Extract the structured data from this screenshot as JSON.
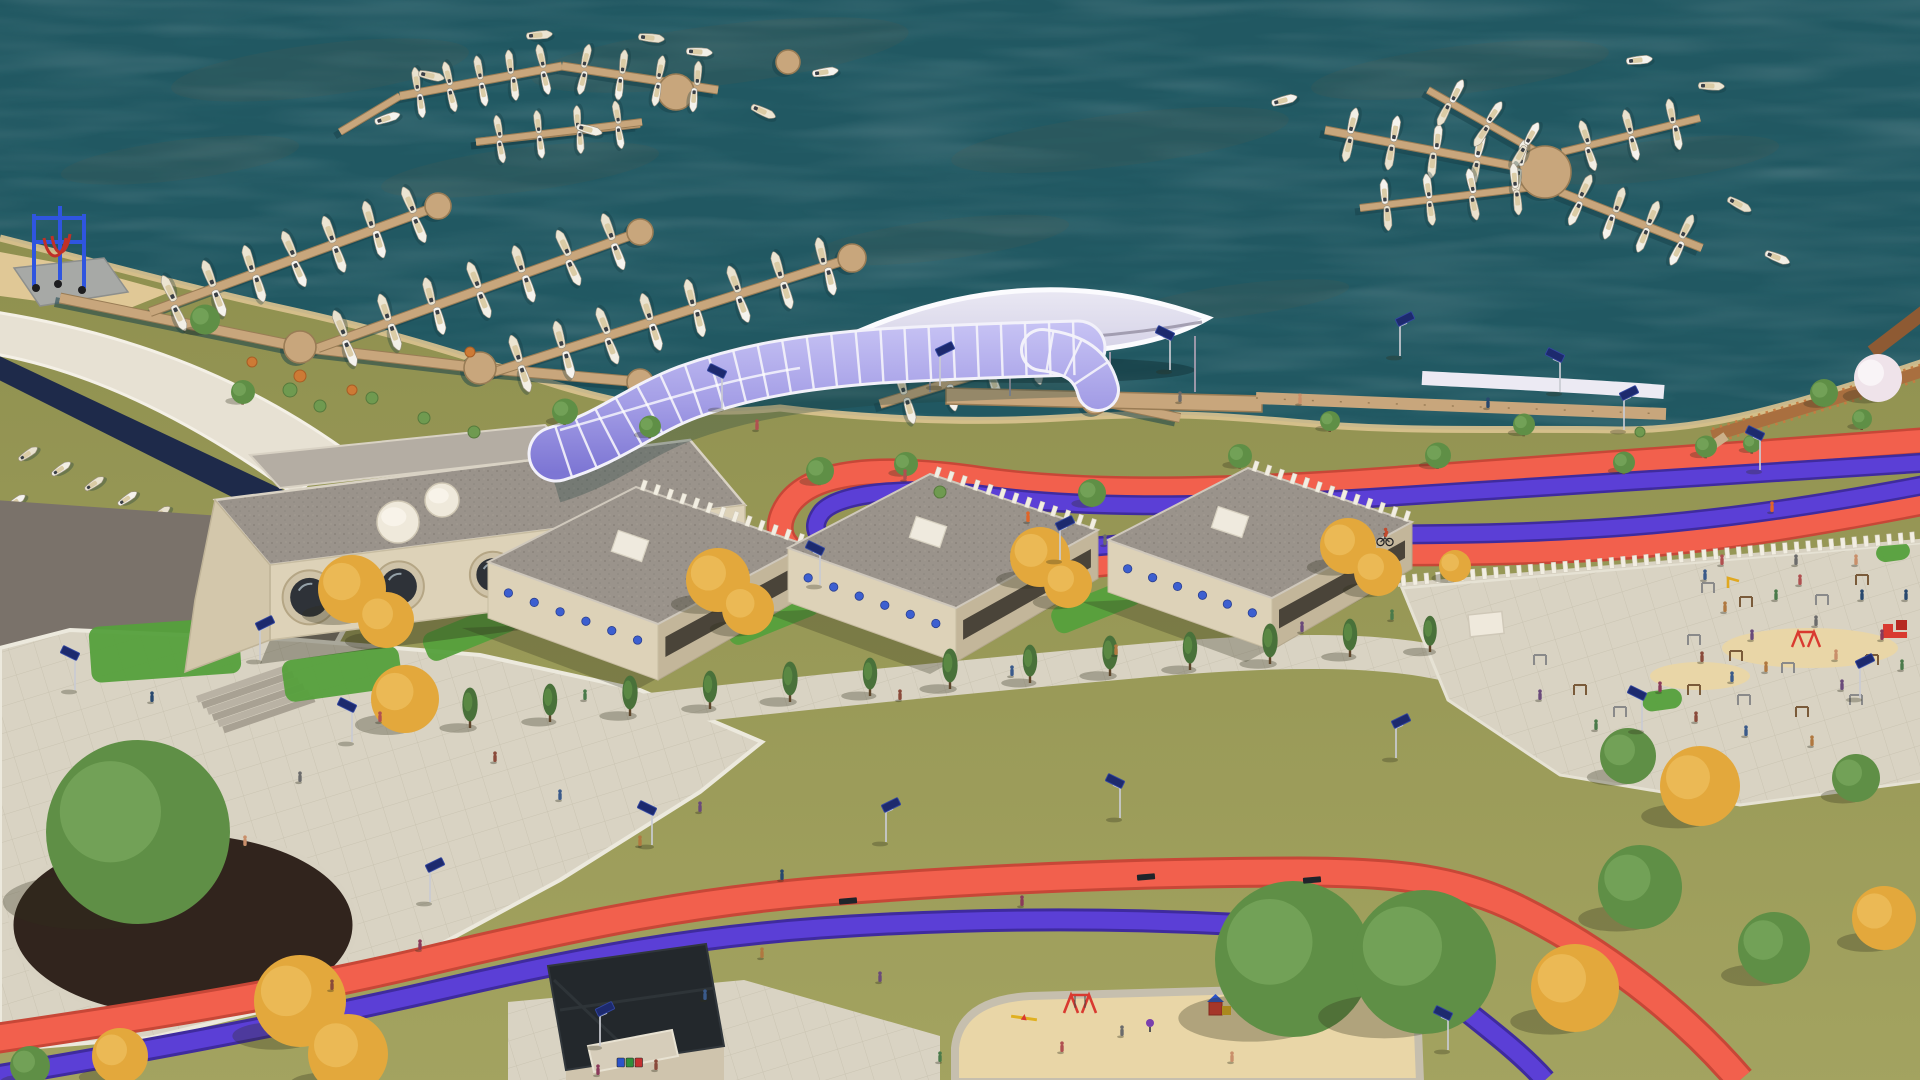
{
  "meta": {
    "title": "Aerial 3D architectural rendering of a marina waterfront development",
    "view": "isometric aerial render, no UI text visible",
    "width": 1920,
    "height": 1080
  },
  "palette": {
    "water": "#26606a",
    "waterDeep": "#1d4f58",
    "dockWood": "#c8a67c",
    "dockEdge": "#997c55",
    "grassA": "#a2a260",
    "grassB": "#8e8f4f",
    "lawnGreen": "#55a03c",
    "pavement": "#d9d3c3",
    "pavementLine": "#c2bba9",
    "sand": "#e9d6a7",
    "asphalt": "#7a726a",
    "mulch": "#31241d",
    "boatDeck": "#d9c9a2",
    "buildingWall": "#ddd2b8",
    "buildingWallShade": "#c3b69a",
    "roofGravel": "#9a938b",
    "roofDot": "#857f77",
    "canopyWhite": "#eceaf3",
    "tubeLight": "#c6c2f4",
    "tubeDark": "#7d76d4",
    "tubeRib": "#f5f4fb",
    "trackRed": "#f2604d",
    "trackRedDark": "#c74737",
    "bikePurple": "#5b3fd6",
    "bikePurpleDark": "#3f2b9e",
    "liftBlue": "#2f55e0",
    "treeGreen": "#5f8f46",
    "treeGreenDark": "#49713a",
    "treeAutumn": "#e3a83c",
    "treeAutumnDark": "#c9882a",
    "treeBloom": "#efe3ea",
    "boardwalk": "#a96f3f",
    "lampPanel": "#1d2a6e",
    "equipRed": "#d93a30",
    "shadow": "#2e2e1c"
  },
  "water": {
    "algae": [
      [
        320,
        70,
        150,
        26
      ],
      [
        720,
        55,
        190,
        30
      ],
      [
        1120,
        140,
        170,
        26
      ],
      [
        520,
        170,
        140,
        22
      ],
      [
        1460,
        70,
        150,
        24
      ],
      [
        940,
        240,
        130,
        20
      ],
      [
        180,
        160,
        120,
        20
      ],
      [
        1660,
        160,
        120,
        20
      ],
      [
        820,
        350,
        120,
        18
      ],
      [
        1240,
        300,
        110,
        16
      ]
    ]
  },
  "marina": {
    "walkways": [
      {
        "pts": [
          [
            60,
            298
          ],
          [
            300,
            347
          ],
          [
            480,
            368
          ],
          [
            640,
            382
          ]
        ],
        "w": 9
      },
      {
        "pts": [
          [
            340,
            132
          ],
          [
            400,
            96
          ]
        ],
        "w": 6
      },
      {
        "pts": [
          [
            476,
            142
          ],
          [
            640,
            124
          ]
        ],
        "w": 6
      },
      {
        "pts": [
          [
            1095,
            400
          ],
          [
            1180,
            418
          ]
        ],
        "w": 8
      }
    ],
    "piers": [
      {
        "x1": 150,
        "y1": 312,
        "x2": 438,
        "y2": 206,
        "w": 8,
        "n": 7,
        "len": 27
      },
      {
        "x1": 318,
        "y1": 348,
        "x2": 640,
        "y2": 232,
        "w": 8,
        "n": 7,
        "len": 27
      },
      {
        "x1": 494,
        "y1": 372,
        "x2": 852,
        "y2": 258,
        "w": 8,
        "n": 8,
        "len": 27
      },
      {
        "x1": 880,
        "y1": 404,
        "x2": 1100,
        "y2": 336,
        "w": 8,
        "n": 5,
        "len": 26
      },
      {
        "x1": 400,
        "y1": 96,
        "x2": 562,
        "y2": 66,
        "w": 7,
        "n": 5,
        "len": 23
      },
      {
        "x1": 562,
        "y1": 66,
        "x2": 718,
        "y2": 90,
        "w": 7,
        "n": 4,
        "len": 23
      },
      {
        "x1": 476,
        "y1": 142,
        "x2": 642,
        "y2": 122,
        "w": 6,
        "n": 4,
        "len": 22
      },
      {
        "x1": 1545,
        "y1": 172,
        "x2": 1325,
        "y2": 130,
        "w": 7,
        "n": 5,
        "len": 25
      },
      {
        "x1": 1548,
        "y1": 158,
        "x2": 1428,
        "y2": 90,
        "w": 6,
        "n": 3,
        "len": 24
      },
      {
        "x1": 1542,
        "y1": 186,
        "x2": 1360,
        "y2": 208,
        "w": 6,
        "n": 4,
        "len": 24
      },
      {
        "x1": 1560,
        "y1": 192,
        "x2": 1702,
        "y2": 248,
        "w": 7,
        "n": 4,
        "len": 25
      },
      {
        "x1": 1562,
        "y1": 152,
        "x2": 1700,
        "y2": 118,
        "w": 6,
        "n": 3,
        "len": 24
      }
    ],
    "platforms": [
      [
        300,
        347,
        16
      ],
      [
        480,
        368,
        16
      ],
      [
        640,
        382,
        13
      ],
      [
        438,
        206,
        13
      ],
      [
        640,
        232,
        13
      ],
      [
        852,
        258,
        14
      ],
      [
        1545,
        172,
        26
      ],
      [
        676,
        92,
        18
      ],
      [
        788,
        62,
        12
      ],
      [
        1095,
        400,
        14
      ]
    ],
    "freeBoats": [
      [
        388,
        118,
        -18
      ],
      [
        432,
        76,
        12
      ],
      [
        700,
        52,
        4
      ],
      [
        764,
        112,
        24
      ],
      [
        826,
        72,
        -8
      ],
      [
        652,
        38,
        6
      ],
      [
        590,
        130,
        15
      ],
      [
        540,
        35,
        -5
      ],
      [
        1285,
        100,
        -15
      ],
      [
        1740,
        205,
        28
      ],
      [
        1778,
        258,
        22
      ],
      [
        1712,
        86,
        2
      ],
      [
        1640,
        60,
        -6
      ]
    ],
    "rackRows": [
      {
        "x1": 12,
        "y1": 446,
        "x2": 244,
        "y2": 550,
        "n": 7
      },
      {
        "x1": 0,
        "y1": 494,
        "x2": 196,
        "y2": 580,
        "n": 6
      }
    ]
  },
  "ship": {
    "portholes": {
      "t": [
        0.08,
        0.27,
        0.47,
        0.67,
        0.86
      ],
      "r": [
        27,
        25,
        23,
        21,
        19
      ]
    },
    "wallTop": [
      272,
      602
    ],
    "wallEnd": [
      742,
      544
    ],
    "cylinders": [
      [
        398,
        522,
        21
      ],
      [
        442,
        500,
        17
      ]
    ]
  },
  "pavilions": [
    {
      "w": [
        488,
        562
      ],
      "n": [
        636,
        487
      ],
      "e": [
        806,
        545
      ],
      "s": [
        658,
        624
      ],
      "h": 56,
      "dots": 6,
      "teeth": 13,
      "box": [
        630,
        546
      ]
    },
    {
      "w": [
        788,
        548
      ],
      "n": [
        930,
        474
      ],
      "e": [
        1098,
        530
      ],
      "s": [
        956,
        608
      ],
      "h": 54,
      "dots": 6,
      "teeth": 13,
      "box": [
        928,
        532
      ]
    },
    {
      "w": [
        1108,
        540
      ],
      "n": [
        1248,
        468
      ],
      "e": [
        1412,
        522
      ],
      "s": [
        1272,
        598
      ],
      "h": 52,
      "dots": 6,
      "teeth": 13,
      "box": [
        1230,
        522
      ]
    }
  ],
  "plazaWall": {
    "x1": 1398,
    "y1": 585,
    "x2": 1930,
    "y2": 540,
    "teeth": 46
  },
  "lawns": [
    [
      165,
      650,
      150,
      56,
      -4
    ],
    [
      342,
      674,
      118,
      42,
      -8
    ],
    [
      470,
      632,
      96,
      30,
      -22
    ],
    [
      772,
      616,
      96,
      30,
      -22
    ],
    [
      1096,
      606,
      92,
      28,
      -22
    ],
    [
      1893,
      552,
      34,
      18,
      -8
    ],
    [
      1662,
      700,
      40,
      20,
      -8
    ]
  ],
  "trees": {
    "green": [
      [
        205,
        327,
        15
      ],
      [
        243,
        398,
        12
      ],
      [
        565,
        418,
        13
      ],
      [
        650,
        432,
        11
      ],
      [
        820,
        478,
        14
      ],
      [
        906,
        470,
        12
      ],
      [
        1092,
        500,
        14
      ],
      [
        1240,
        462,
        12
      ],
      [
        1330,
        426,
        10
      ],
      [
        1438,
        462,
        13
      ],
      [
        1524,
        430,
        11
      ],
      [
        1624,
        468,
        11
      ],
      [
        1706,
        452,
        11
      ],
      [
        1752,
        448,
        9
      ],
      [
        1824,
        400,
        14
      ],
      [
        1862,
        424,
        10
      ],
      [
        138,
        878,
        92
      ],
      [
        1293,
        998,
        78
      ],
      [
        1424,
        998,
        72
      ],
      [
        1640,
        908,
        42
      ],
      [
        1774,
        966,
        36
      ],
      [
        1628,
        770,
        28
      ],
      [
        1856,
        790,
        24
      ],
      [
        30,
        1076,
        20
      ]
    ],
    "autumn": [
      [
        352,
        606,
        34
      ],
      [
        386,
        634,
        28
      ],
      [
        718,
        596,
        32
      ],
      [
        748,
        622,
        26
      ],
      [
        1040,
        572,
        30
      ],
      [
        1068,
        596,
        24
      ],
      [
        1348,
        560,
        28
      ],
      [
        1378,
        584,
        24
      ],
      [
        405,
        716,
        34
      ],
      [
        300,
        1024,
        46
      ],
      [
        348,
        1074,
        40
      ],
      [
        120,
        1070,
        28
      ],
      [
        1455,
        574,
        16
      ],
      [
        1700,
        806,
        40
      ],
      [
        1575,
        1010,
        44
      ],
      [
        1884,
        934,
        32
      ]
    ],
    "slim": [
      [
        470,
        724,
        17
      ],
      [
        550,
        718,
        16
      ],
      [
        630,
        712,
        17
      ],
      [
        710,
        705,
        16
      ],
      [
        790,
        698,
        17
      ],
      [
        870,
        692,
        16
      ],
      [
        950,
        685,
        17
      ],
      [
        1030,
        679,
        16
      ],
      [
        1110,
        672,
        17
      ],
      [
        1190,
        666,
        16
      ],
      [
        1270,
        660,
        17
      ],
      [
        1350,
        653,
        16
      ],
      [
        1430,
        648,
        15
      ]
    ],
    "bloom": [
      [
        1878,
        390,
        24
      ]
    ],
    "shrubsGreen": [
      [
        290,
        390,
        7
      ],
      [
        320,
        406,
        6
      ],
      [
        372,
        398,
        6
      ],
      [
        424,
        418,
        6
      ],
      [
        474,
        432,
        6
      ],
      [
        940,
        492,
        6
      ],
      [
        1640,
        432,
        5
      ]
    ],
    "shrubsOrange": [
      [
        300,
        376,
        6
      ],
      [
        352,
        390,
        5
      ],
      [
        252,
        362,
        5
      ],
      [
        470,
        352,
        5
      ]
    ]
  },
  "lamps": [
    [
      352,
      742
    ],
    [
      430,
      902
    ],
    [
      652,
      845
    ],
    [
      886,
      842
    ],
    [
      1120,
      818
    ],
    [
      1396,
      758
    ],
    [
      1642,
      730
    ],
    [
      1860,
      698
    ],
    [
      722,
      408
    ],
    [
      940,
      386
    ],
    [
      1170,
      370
    ],
    [
      1400,
      356
    ],
    [
      1560,
      392
    ],
    [
      1624,
      430
    ],
    [
      1760,
      470
    ],
    [
      600,
      1046
    ],
    [
      1448,
      1050
    ],
    [
      260,
      660
    ],
    [
      75,
      690
    ],
    [
      1060,
      560
    ],
    [
      820,
      585
    ]
  ],
  "benches": [
    [
      848,
      901
    ],
    [
      1146,
      877
    ],
    [
      1312,
      880
    ]
  ],
  "people": [
    [
      495,
      762
    ],
    [
      560,
      800
    ],
    [
      640,
      846
    ],
    [
      700,
      812
    ],
    [
      585,
      700
    ],
    [
      380,
      722
    ],
    [
      300,
      782
    ],
    [
      245,
      846
    ],
    [
      152,
      702
    ],
    [
      420,
      950
    ],
    [
      332,
      990
    ],
    [
      705,
      1000
    ],
    [
      762,
      958
    ],
    [
      880,
      982
    ],
    [
      940,
      1062
    ],
    [
      1062,
      1052
    ],
    [
      1122,
      1036
    ],
    [
      1232,
      1062
    ],
    [
      782,
      880
    ],
    [
      1022,
      906
    ],
    [
      900,
      700
    ],
    [
      1012,
      676
    ],
    [
      1116,
      655
    ],
    [
      1302,
      632
    ],
    [
      1392,
      620
    ],
    [
      757,
      430
    ],
    [
      1180,
      402
    ],
    [
      1300,
      404
    ],
    [
      1488,
      408
    ],
    [
      598,
      1075
    ],
    [
      656,
      1070
    ],
    [
      1705,
      580
    ],
    [
      1725,
      612
    ],
    [
      1752,
      640
    ],
    [
      1776,
      600
    ],
    [
      1800,
      585
    ],
    [
      1816,
      626
    ],
    [
      1836,
      660
    ],
    [
      1862,
      600
    ],
    [
      1882,
      640
    ],
    [
      1702,
      662
    ],
    [
      1732,
      682
    ],
    [
      1766,
      672
    ],
    [
      1842,
      690
    ],
    [
      1902,
      670
    ],
    [
      1722,
      565
    ],
    [
      1796,
      565
    ],
    [
      1856,
      565
    ],
    [
      1906,
      600
    ],
    [
      1660,
      692
    ],
    [
      1696,
      722
    ],
    [
      1746,
      736
    ],
    [
      1812,
      746
    ],
    [
      1540,
      700
    ],
    [
      1596,
      730
    ],
    [
      905,
      480
    ],
    [
      1105,
      545
    ]
  ],
  "runners": [
    [
      1028,
      522
    ],
    [
      1772,
      512
    ]
  ],
  "cyclists": [
    [
      1385,
      540
    ]
  ],
  "playground": {
    "swings": [
      [
        1080,
        1004
      ]
    ],
    "seesaws": [
      [
        1024,
        1018
      ]
    ],
    "springs": [
      [
        1150,
        1026
      ]
    ],
    "climbers": [
      [
        1218,
        1010
      ]
    ]
  },
  "fitness": {
    "bars": [
      [
        1708,
        588
      ],
      [
        1746,
        602
      ],
      [
        1694,
        640
      ],
      [
        1736,
        656
      ],
      [
        1788,
        668
      ],
      [
        1694,
        690
      ],
      [
        1744,
        700
      ],
      [
        1802,
        712
      ],
      [
        1856,
        700
      ],
      [
        1872,
        660
      ],
      [
        1822,
        600
      ],
      [
        1862,
        580
      ],
      [
        1540,
        660
      ],
      [
        1580,
        690
      ],
      [
        1620,
        712
      ]
    ],
    "redStations": [
      [
        1895,
        632
      ]
    ],
    "redSwings": [
      [
        1806,
        640
      ]
    ],
    "yellow": [
      [
        1733,
        583
      ]
    ],
    "kiosk": [
      1468,
      615,
      34,
      22
    ]
  },
  "bins": {
    "x": 617,
    "y": 1058,
    "colors": [
      "#2b53c9",
      "#2f8f3a",
      "#c43030"
    ]
  }
}
